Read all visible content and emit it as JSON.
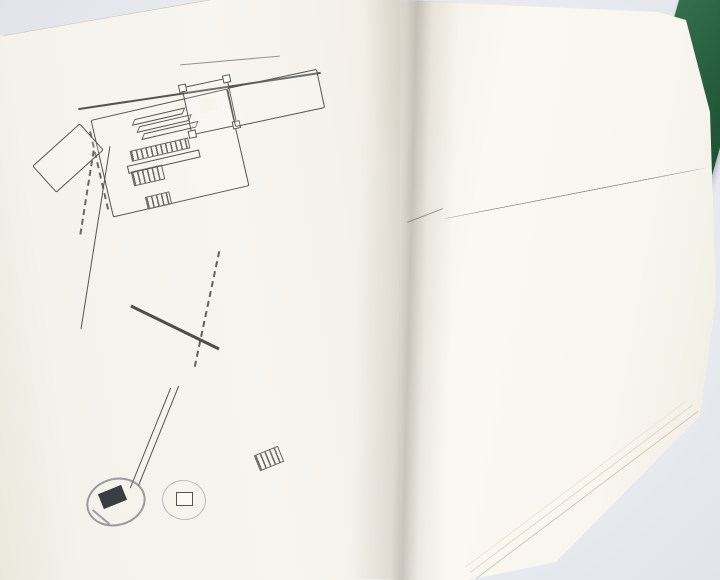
{
  "photo": {
    "background": "#e9ecef",
    "book_cover_color": "#27603f",
    "paper_color": "#f8f6ef"
  },
  "left_page": {
    "spine_title": "《ふじ亭》見取図",
    "landmarks": {
      "mise": "店",
      "yashiro": "社",
      "tsutsumi": "堤",
      "nagaya": "長屋",
      "dote": "土手",
      "sakamichi": "坂道",
      "pencil_note": "5-2・4/24"
    },
    "buildings": [
      {
        "letter": "H",
        "label": "(ふじ亭)",
        "pos": "inr",
        "x": 140,
        "y": 147,
        "w": 67,
        "h": 50,
        "rot": -12
      },
      {
        "letter": "I",
        "label": "(瀬戸物屋)",
        "pos": "inr",
        "x": 148,
        "y": 199,
        "w": 62,
        "h": 57,
        "rot": -12
      },
      {
        "letter": "J",
        "label": "(物干場)",
        "label_top": "(呑み場)酒屋",
        "pos": "inb",
        "x": 158,
        "y": 256,
        "w": 67,
        "h": 60,
        "rot": -14
      },
      {
        "letter": "A",
        "label": "(薬屋)",
        "pos": "inl",
        "x": 234,
        "y": 133,
        "w": 70,
        "h": 45,
        "rot": -13,
        "annex": true
      },
      {
        "letter": "B",
        "label": "(春・山口屋)",
        "pos": "outl",
        "x": 258,
        "y": 198,
        "w": 53,
        "h": 47,
        "rot": -13
      },
      {
        "letter": "C",
        "label": "(春・駿河屋)",
        "pos": "inl",
        "x": 257,
        "y": 250,
        "w": 56,
        "h": 44,
        "rot": -14
      },
      {
        "letter": "D",
        "label": "越前屋(相模屋)",
        "pos": "inl",
        "x": 268,
        "y": 298,
        "w": 61,
        "h": 80,
        "rot": -16
      },
      {
        "letter": "E",
        "label": "(多ヶ三家)",
        "pos": "inl",
        "x": 258,
        "y": 392,
        "w": 61,
        "h": 58,
        "rot": -18
      },
      {
        "letter": "F",
        "label": "(釣り具・甘茶)",
        "pos": "inl",
        "x": 246,
        "y": 460,
        "w": 58,
        "h": 87,
        "rot": -22
      },
      {
        "letter": "G",
        "label": "(船宿)富士",
        "pos": "inl",
        "x": 198,
        "y": 528,
        "w": 68,
        "h": 52,
        "rot": -28
      },
      {
        "letter": "K",
        "label": "(雑貨・駄菓子)",
        "pos": "inb",
        "x": 133,
        "y": 410,
        "w": 72,
        "h": 72,
        "rot": -25
      },
      {
        "letter": "L",
        "label": "(倉)",
        "pos": "inb",
        "x": 90,
        "y": 388,
        "w": 64,
        "h": 77,
        "rot": -20
      }
    ],
    "ghost_stamps": [
      {
        "text": "新",
        "x": 44,
        "y": 72,
        "size": 17,
        "rot": -12,
        "o": 0.38,
        "blur": 0.5
      },
      {
        "text": "東京都港区赤坂",
        "x": 130,
        "y": 30,
        "size": 21,
        "rot": -9,
        "o": 0.18,
        "blur": 2.5
      },
      {
        "text": "TBS旧館",
        "x": 212,
        "y": 298,
        "size": 13,
        "rot": -14,
        "o": 0.42,
        "blur": 0.4
      },
      {
        "text": "TBS別館",
        "x": 222,
        "y": 322,
        "size": 13,
        "rot": -14,
        "o": 0.4,
        "blur": 0.4
      },
      {
        "text": "ゴルフショップ",
        "x": 228,
        "y": 384,
        "size": 9,
        "rot": -14,
        "o": 0.4,
        "blur": 0.3
      },
      {
        "text": "第6号",
        "x": 268,
        "y": 520,
        "size": 13,
        "rot": -13,
        "o": 0.38,
        "blur": 0.4
      },
      {
        "text": "TBS別館",
        "x": 322,
        "y": 505,
        "size": 14,
        "rot": -13,
        "o": 0.42,
        "blur": 0.4
      },
      {
        "text": "東京都港区赤坂",
        "x": 40,
        "y": 548,
        "size": 20,
        "rot": -17,
        "o": 0.38,
        "blur": 0.5
      }
    ]
  },
  "right_page": {
    "script": {
      "speaker": "かめ",
      "dialogue": "「私は小物……」",
      "direction1": "二人、顔見合わせて笑う。",
      "direction2": "去ってゆく二人をいつまでも見送って",
      "end_mark": "(END)"
    },
    "page_number": "― 78 ―",
    "ghost_columns": [
      {
        "x": 428,
        "y": 208,
        "h": 150,
        "text": "それから二人は……",
        "o": 0.2
      },
      {
        "x": 447,
        "y": 200,
        "h": 220,
        "text": "「おまえさんのことだから」",
        "o": 0.24
      },
      {
        "x": 466,
        "y": 206,
        "h": 250,
        "text": "……と笑いながら歩いて",
        "o": 0.2
      },
      {
        "x": 486,
        "y": 210,
        "h": 255,
        "text": "二人の後ろ姿が小さくなる",
        "o": 0.26
      },
      {
        "x": 506,
        "y": 216,
        "h": 265,
        "text": "「ハハハ……それもそうだ」",
        "o": 0.23
      },
      {
        "x": 526,
        "y": 222,
        "h": 270,
        "text": "……いつまでも続いている",
        "o": 0.2
      },
      {
        "x": 546,
        "y": 228,
        "h": 265,
        "text": "「また明日もよろしく頼むよ」",
        "o": 0.27
      },
      {
        "x": 566,
        "y": 234,
        "h": 255,
        "text": "二人ゆっくりと歩き出して",
        "o": 0.23
      },
      {
        "x": 586,
        "y": 240,
        "h": 235,
        "text": "「それじゃあ、また……」",
        "o": 0.26
      },
      {
        "x": 606,
        "y": 248,
        "h": 200,
        "text": "……の中へ消えてゆく二人",
        "o": 0.22
      },
      {
        "x": 626,
        "y": 256,
        "h": 150,
        "text": "「ああ……」と、かめ",
        "o": 0.28
      },
      {
        "x": 414,
        "y": 246,
        "h": 110,
        "text": "ハ ハ",
        "o": 0.32
      },
      {
        "x": 432,
        "y": 300,
        "h": 180,
        "text": "……………",
        "o": 0.18
      }
    ]
  }
}
